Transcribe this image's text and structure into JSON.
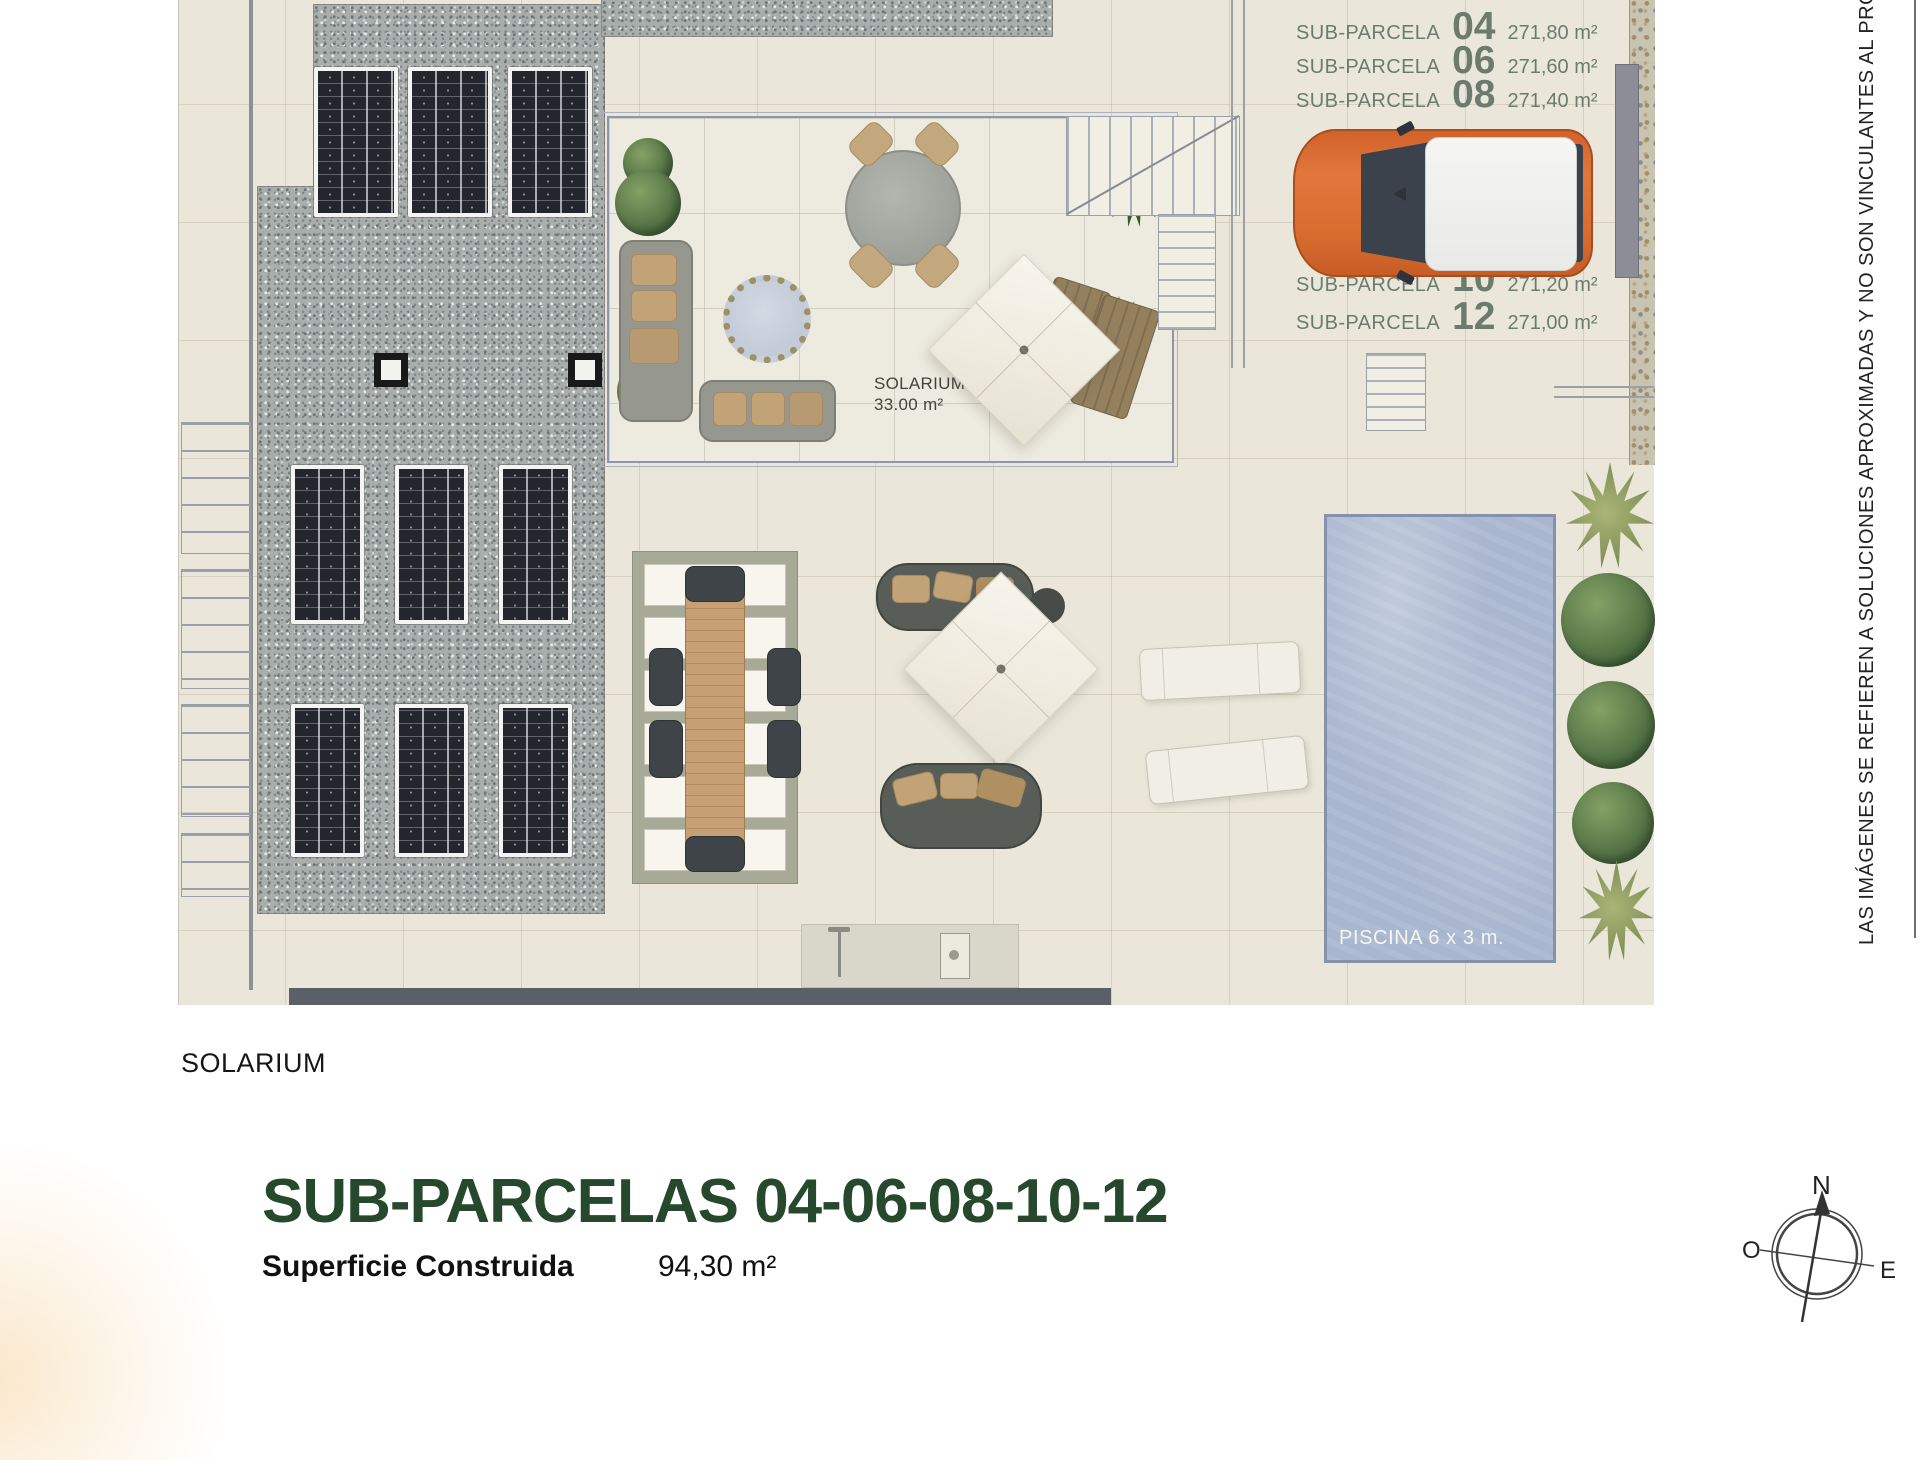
{
  "colors": {
    "title_green": "#26482c",
    "parcel_label_green": "#6b7c6f",
    "pool_blue": "#a9b6cf",
    "car_orange": "#d96d30",
    "paving_beige": "#eae7da",
    "gravel_grey": "#a9aeac",
    "wall_dark": "#5a5f68"
  },
  "plan": {
    "solarium_label": {
      "name": "SOLARIUM",
      "area": "33.00 m²"
    },
    "piscina_label": "PISCINA 6 x 3 m.",
    "parcels_top": [
      {
        "prefix": "SUB-PARCELA",
        "number": "04",
        "area": "271,80 m²"
      },
      {
        "prefix": "SUB-PARCELA",
        "number": "06",
        "area": "271,60 m²"
      },
      {
        "prefix": "SUB-PARCELA",
        "number": "08",
        "area": "271,40 m²"
      }
    ],
    "parcels_bottom": [
      {
        "prefix": "SUB-PARCELA",
        "number": "10",
        "area": "271,20 m²"
      },
      {
        "prefix": "SUB-PARCELA",
        "number": "12",
        "area": "271,00 m²"
      }
    ]
  },
  "footer": {
    "floor_label": "SOLARIUM",
    "title": "SUB-PARCELAS 04-06-08-10-12",
    "surface_label": "Superficie Construida",
    "surface_value": "94,30 m²"
  },
  "disclaimer": "LAS IMÁGENES SE REFIEREN A SOLUCIONES APROXIMADAS Y NO SON VINCULANTES AL PROYECTO",
  "compass": {
    "north": "N",
    "west": "O",
    "east": "E"
  }
}
